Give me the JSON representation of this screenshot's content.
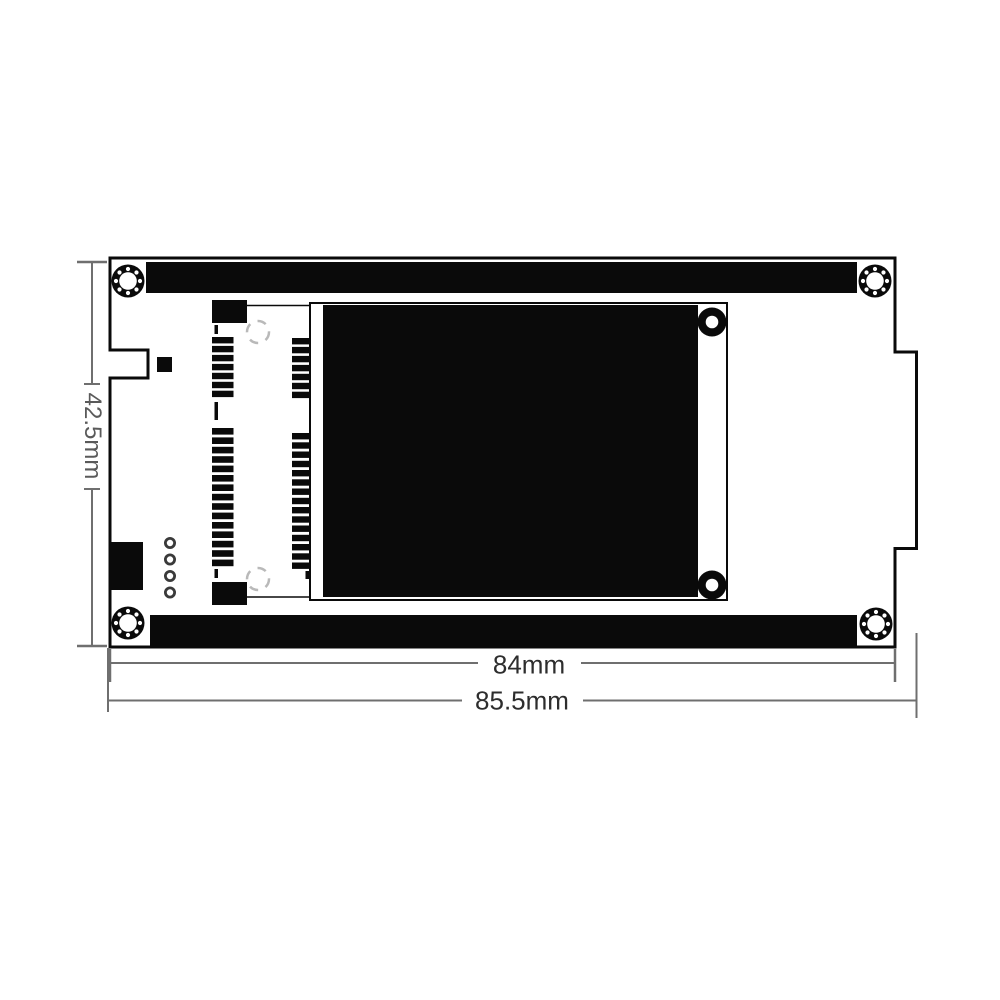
{
  "diagram": {
    "type": "pcb-dimension-drawing",
    "labels": {
      "height": "42.5mm",
      "board_width": "84mm",
      "overall_width": "85.5mm"
    },
    "colors": {
      "background": "#ffffff",
      "ink": "#0a0a0a",
      "dimension_line": "#6f6f6f",
      "dimension_text": "#2d2d2d",
      "dimension_text_vertical": "#5a5a5a",
      "silkscreen": "#b9b9b9"
    }
  }
}
